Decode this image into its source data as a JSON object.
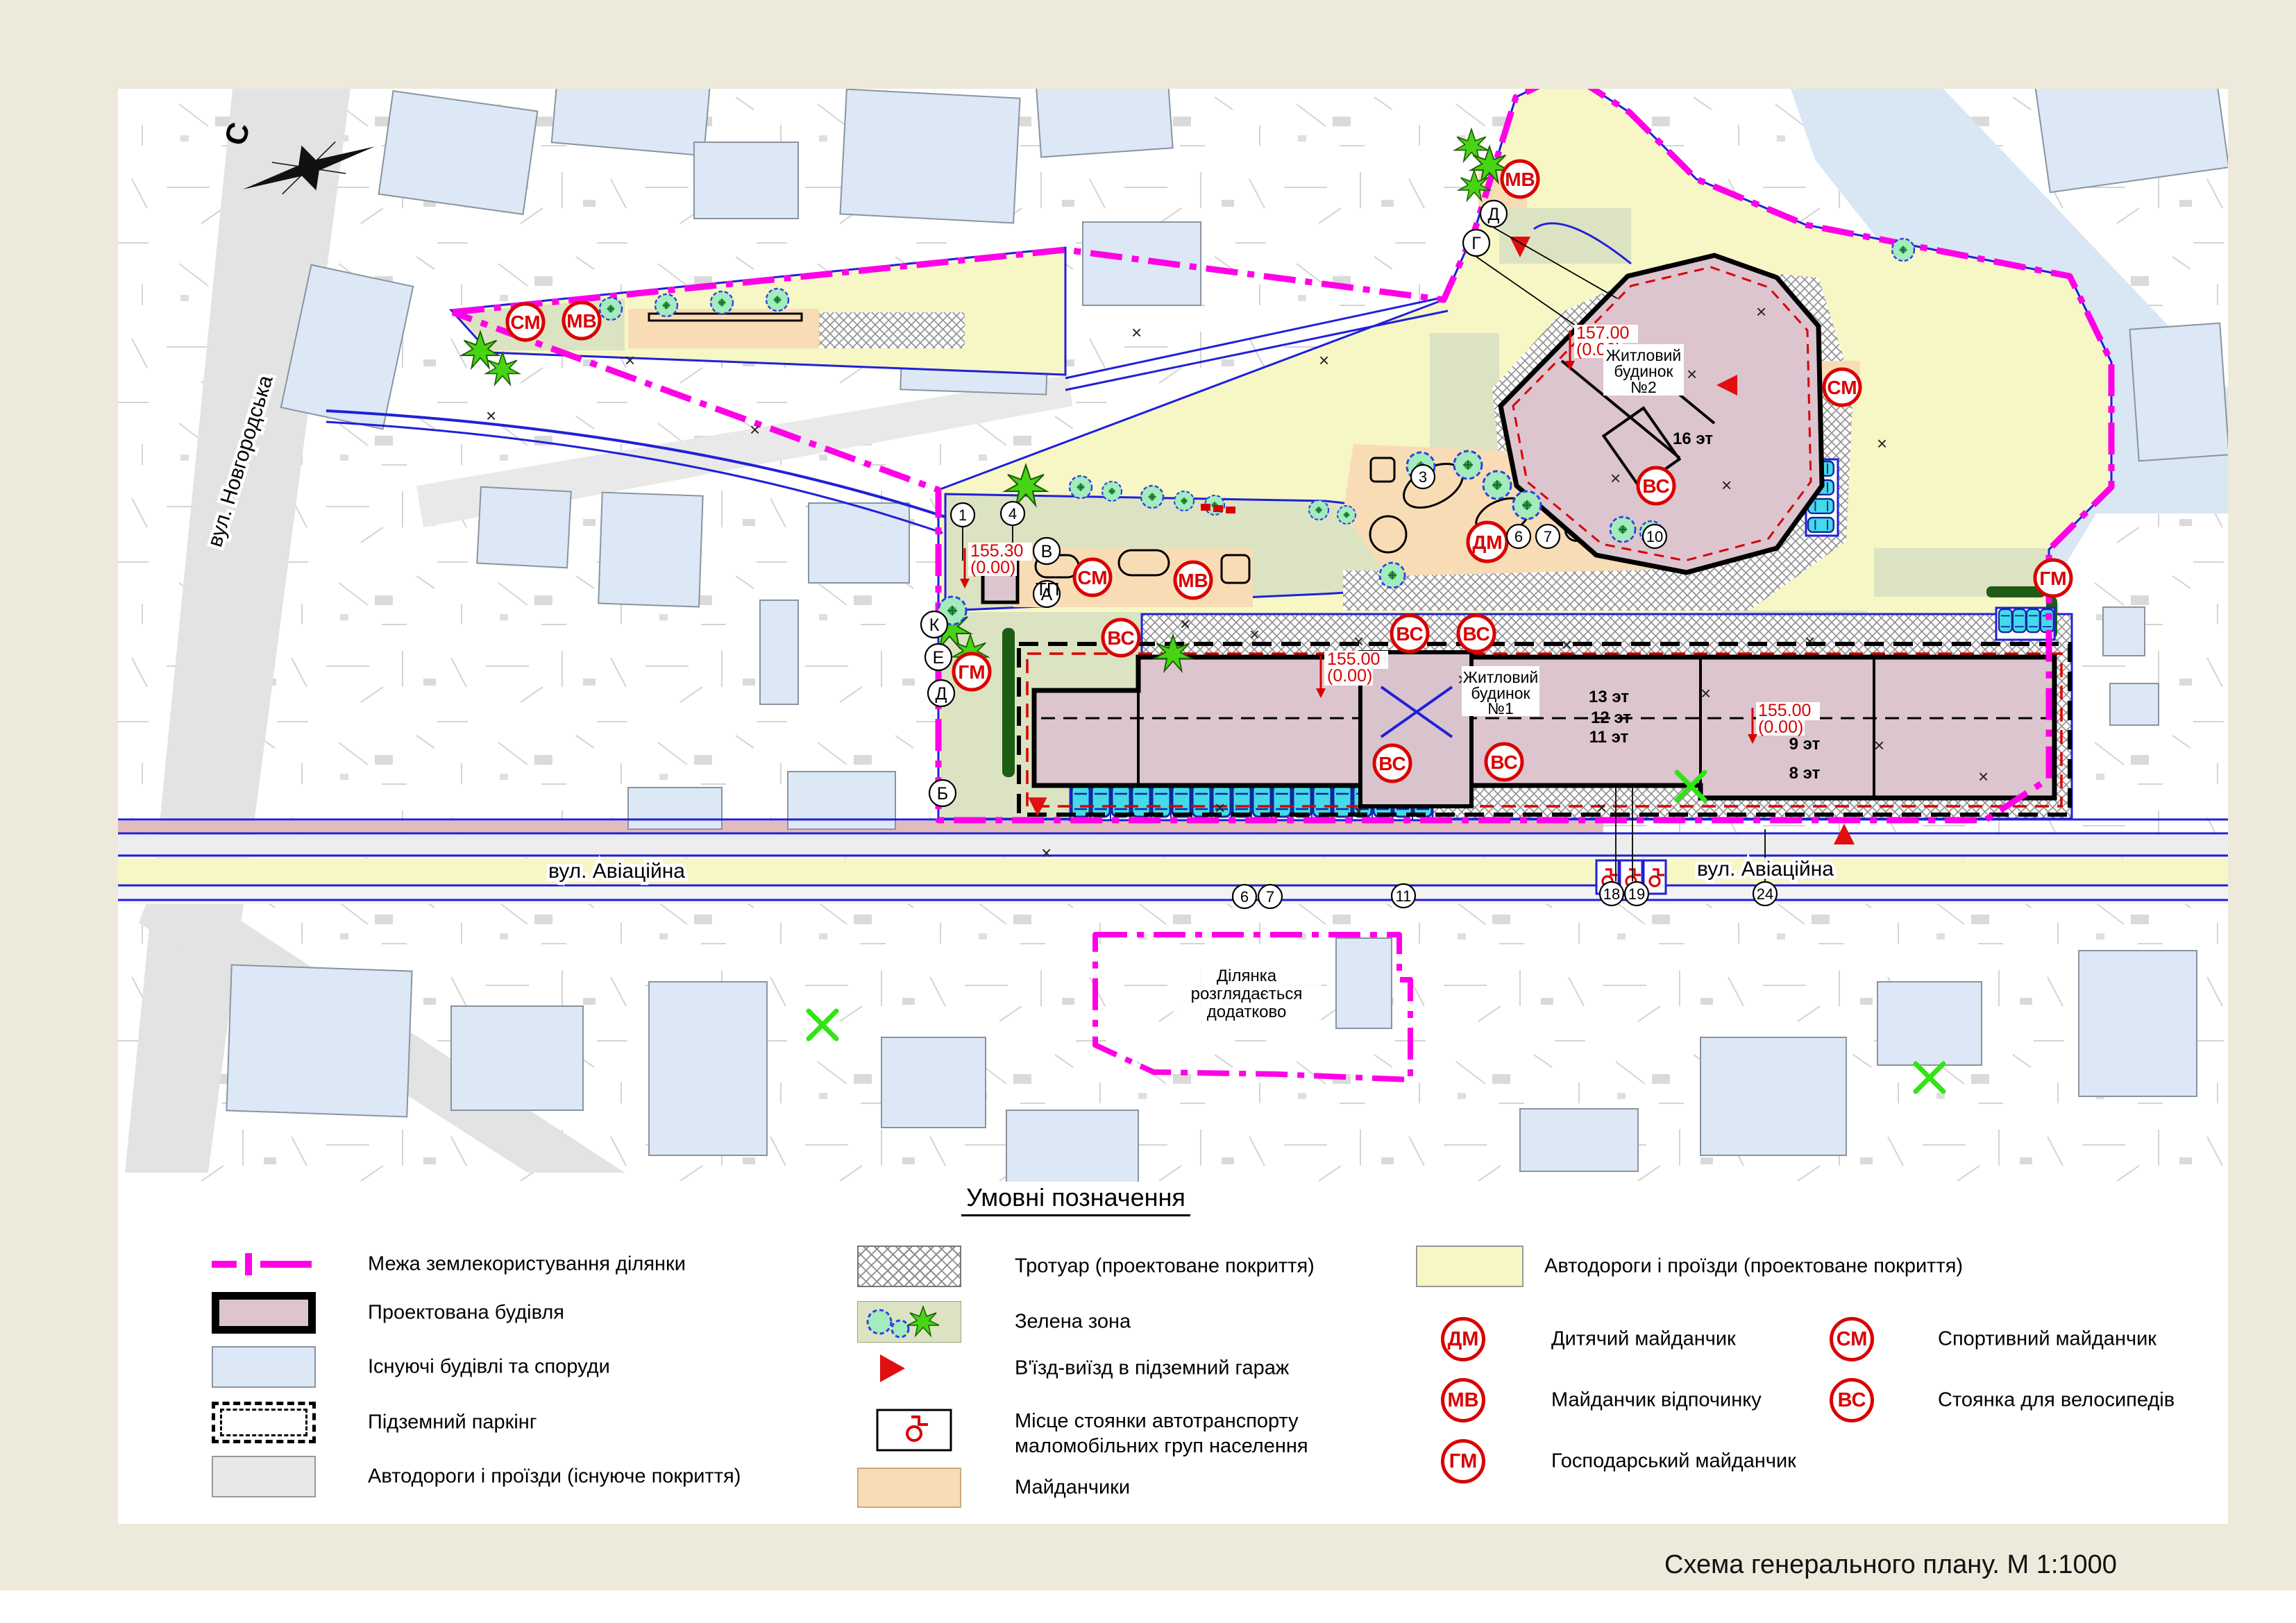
{
  "sheet": {
    "title_block": "Схема  генерального плану. М 1:1000"
  },
  "map": {
    "north_label": "С",
    "street_novgorodska": "вул. Новгородська",
    "street_aviatsiina_left": "вул. Авіаційна",
    "street_aviatsiina_right": "вул. Авіаційна",
    "building1_lines": [
      "Житловий",
      "будинок",
      "№1"
    ],
    "building2_lines": [
      "Житловий",
      "будинок",
      "№2"
    ],
    "tp_label": "ТП",
    "parcel_note_lines": [
      "Ділянка",
      "розглядається",
      "додатково"
    ],
    "floor_labels": [
      "13 эт",
      "12 эт",
      "11 эт",
      "9 эт",
      "8 эт",
      "16 эт"
    ],
    "elevation_marks": [
      {
        "value": "155.00",
        "datum": "(0.00)"
      },
      {
        "value": "155.30",
        "datum": "(0.00)"
      },
      {
        "value": "157.00",
        "datum": "(0.00)"
      },
      {
        "value": "155.00",
        "datum": "(0.00)"
      }
    ],
    "symbol_codes": [
      "МВ",
      "ВС",
      "СМ",
      "СМ",
      "МВ",
      "СМ",
      "МВ",
      "ДМ",
      "ВС",
      "ГМ",
      "ВС",
      "ВС",
      "ВС",
      "ВС",
      "ГМ"
    ],
    "callout_numbers": [
      "1",
      "4",
      "3",
      "6",
      "7",
      "10",
      "6",
      "7",
      "11",
      "18",
      "19",
      "24"
    ],
    "callout_letters": [
      "В",
      "А",
      "К",
      "Е",
      "Д",
      "Б",
      "Д",
      "Г"
    ]
  },
  "legend": {
    "title": "Умовні позначення",
    "left": [
      {
        "label": "Межа землекористування ділянки"
      },
      {
        "label": "Проектована будівля"
      },
      {
        "label": "Існуючі будівлі та споруди"
      },
      {
        "label": "Підземний паркінг"
      },
      {
        "label": "Автодороги і проїзди (існуюче покриття)"
      }
    ],
    "middle": [
      {
        "label": "Тротуар (проектоване покриття)"
      },
      {
        "label": "Зелена зона"
      },
      {
        "label": "В'їзд-виїзд в підземний гараж"
      },
      {
        "label": "Місце стоянки автотранспорту",
        "label2": "маломобільних груп населення"
      },
      {
        "label": "Майданчики"
      }
    ],
    "right_road_label": "Автодороги і проїзди (проектоване покриття)",
    "symbols": [
      {
        "code": "ДМ",
        "label": "Дитячий майданчик"
      },
      {
        "code": "МВ",
        "label": "Майданчик відпочинку"
      },
      {
        "code": "ГМ",
        "label": "Господарський майданчик"
      },
      {
        "code": "СМ",
        "label": "Спортивний майданчик"
      },
      {
        "code": "ВС",
        "label": "Стоянка для велосипедів"
      }
    ]
  },
  "colors": {
    "boundary_magenta": "#FF00E6",
    "projected_building": "#DCC5CF",
    "existing_building": "#DCE8F5",
    "road_existing": "#E8E8E8",
    "road_projected": "#F7F6C5",
    "green_zone": "#DCE3C2",
    "playground": "#F8DCB6",
    "curb_blue": "#2020D8",
    "symbol_red": "#D90000",
    "car_cyan": "#43DBE8"
  }
}
